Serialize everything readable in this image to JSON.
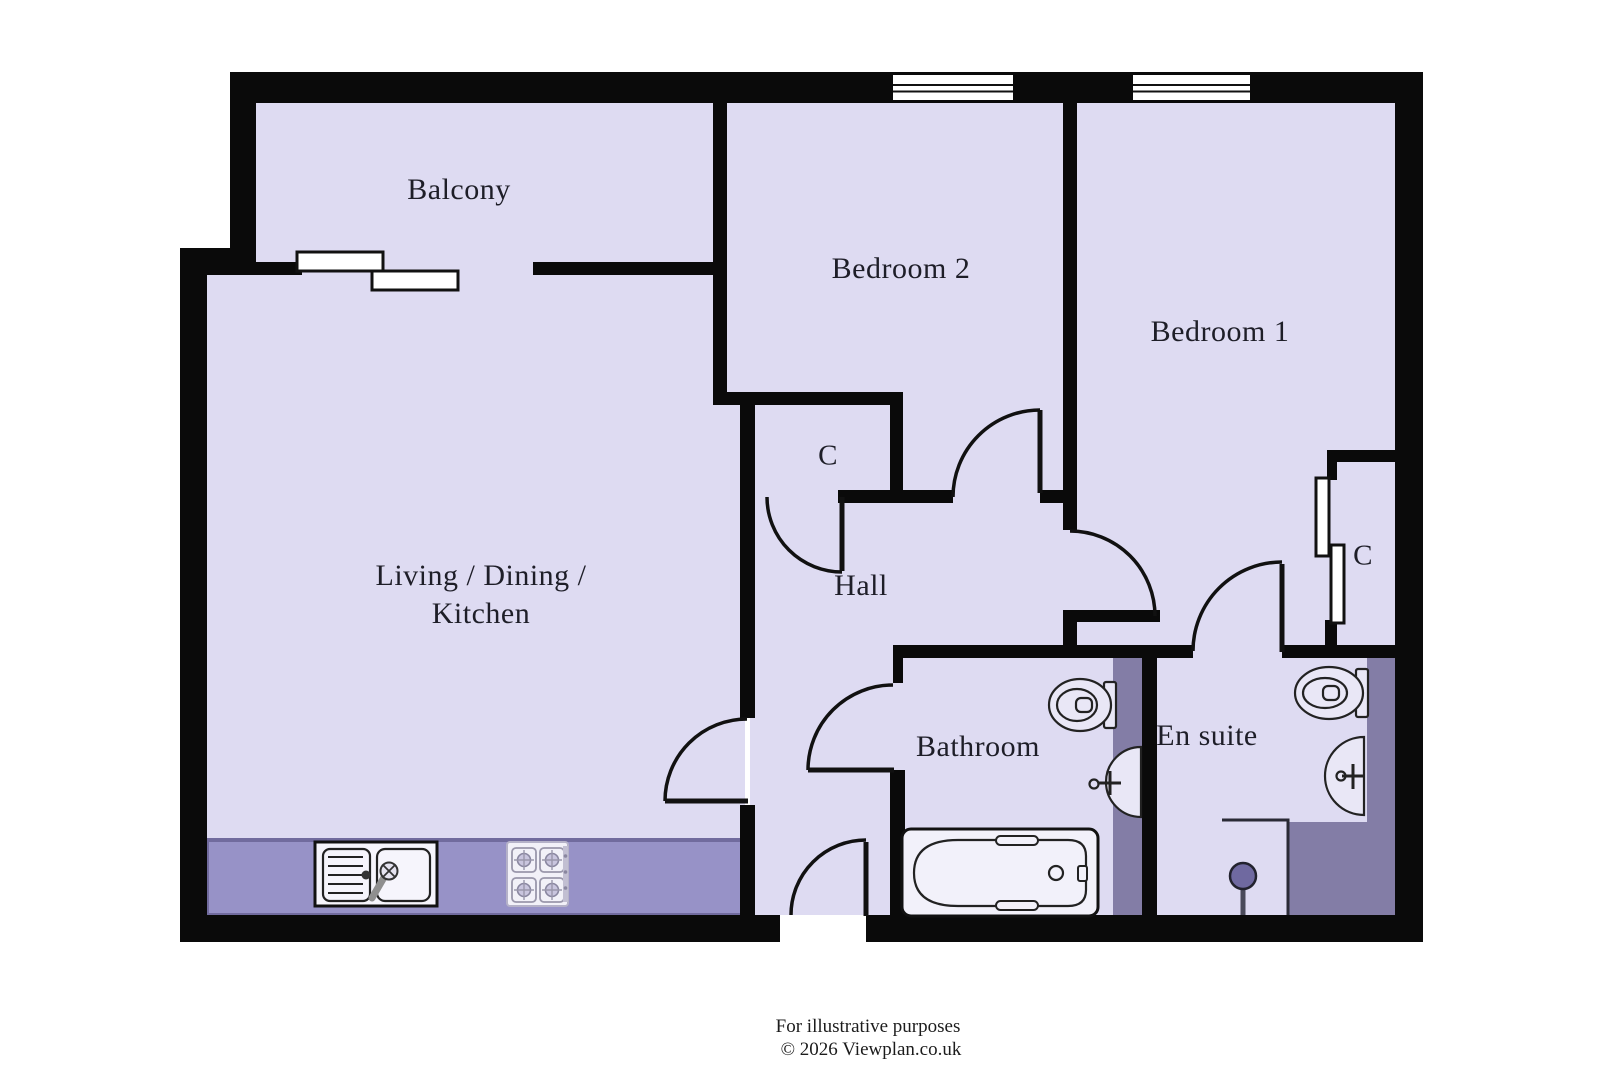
{
  "floorplan": {
    "rooms": {
      "balcony": {
        "label": "Balcony"
      },
      "bedroom2": {
        "label": "Bedroom 2"
      },
      "bedroom1": {
        "label": "Bedroom 1"
      },
      "living": {
        "label_line1": "Living / Dining /",
        "label_line2": "Kitchen"
      },
      "hall": {
        "label": "Hall"
      },
      "bathroom": {
        "label": "Bathroom"
      },
      "ensuite": {
        "label": "En suite"
      },
      "closet_hall": {
        "label": "C"
      },
      "closet_bedroom1": {
        "label": "C"
      }
    },
    "footer": {
      "line1": "For illustrative purposes",
      "line2": "© 2026 Viewplan.co.uk"
    },
    "colors": {
      "wall": "#0a0a0a",
      "floor": "#dedbf2",
      "outside": "#ffffff",
      "counter": "#9792c7",
      "counter_border": "#716b9e",
      "tile": "#837da6",
      "shower_head": "#6f69a0",
      "fixture": "#e9e7f6",
      "text": "#1e1e28"
    },
    "icons": {
      "kitchen_sink": "kitchen-sink-icon",
      "hob": "hob-icon",
      "bathtub": "bathtub-icon",
      "toilet": "toilet-icon",
      "basin": "wash-basin-icon",
      "shower": "shower-icon",
      "window": "window-icon",
      "sliding_door": "sliding-door-icon",
      "door": "door-arc-icon"
    }
  }
}
